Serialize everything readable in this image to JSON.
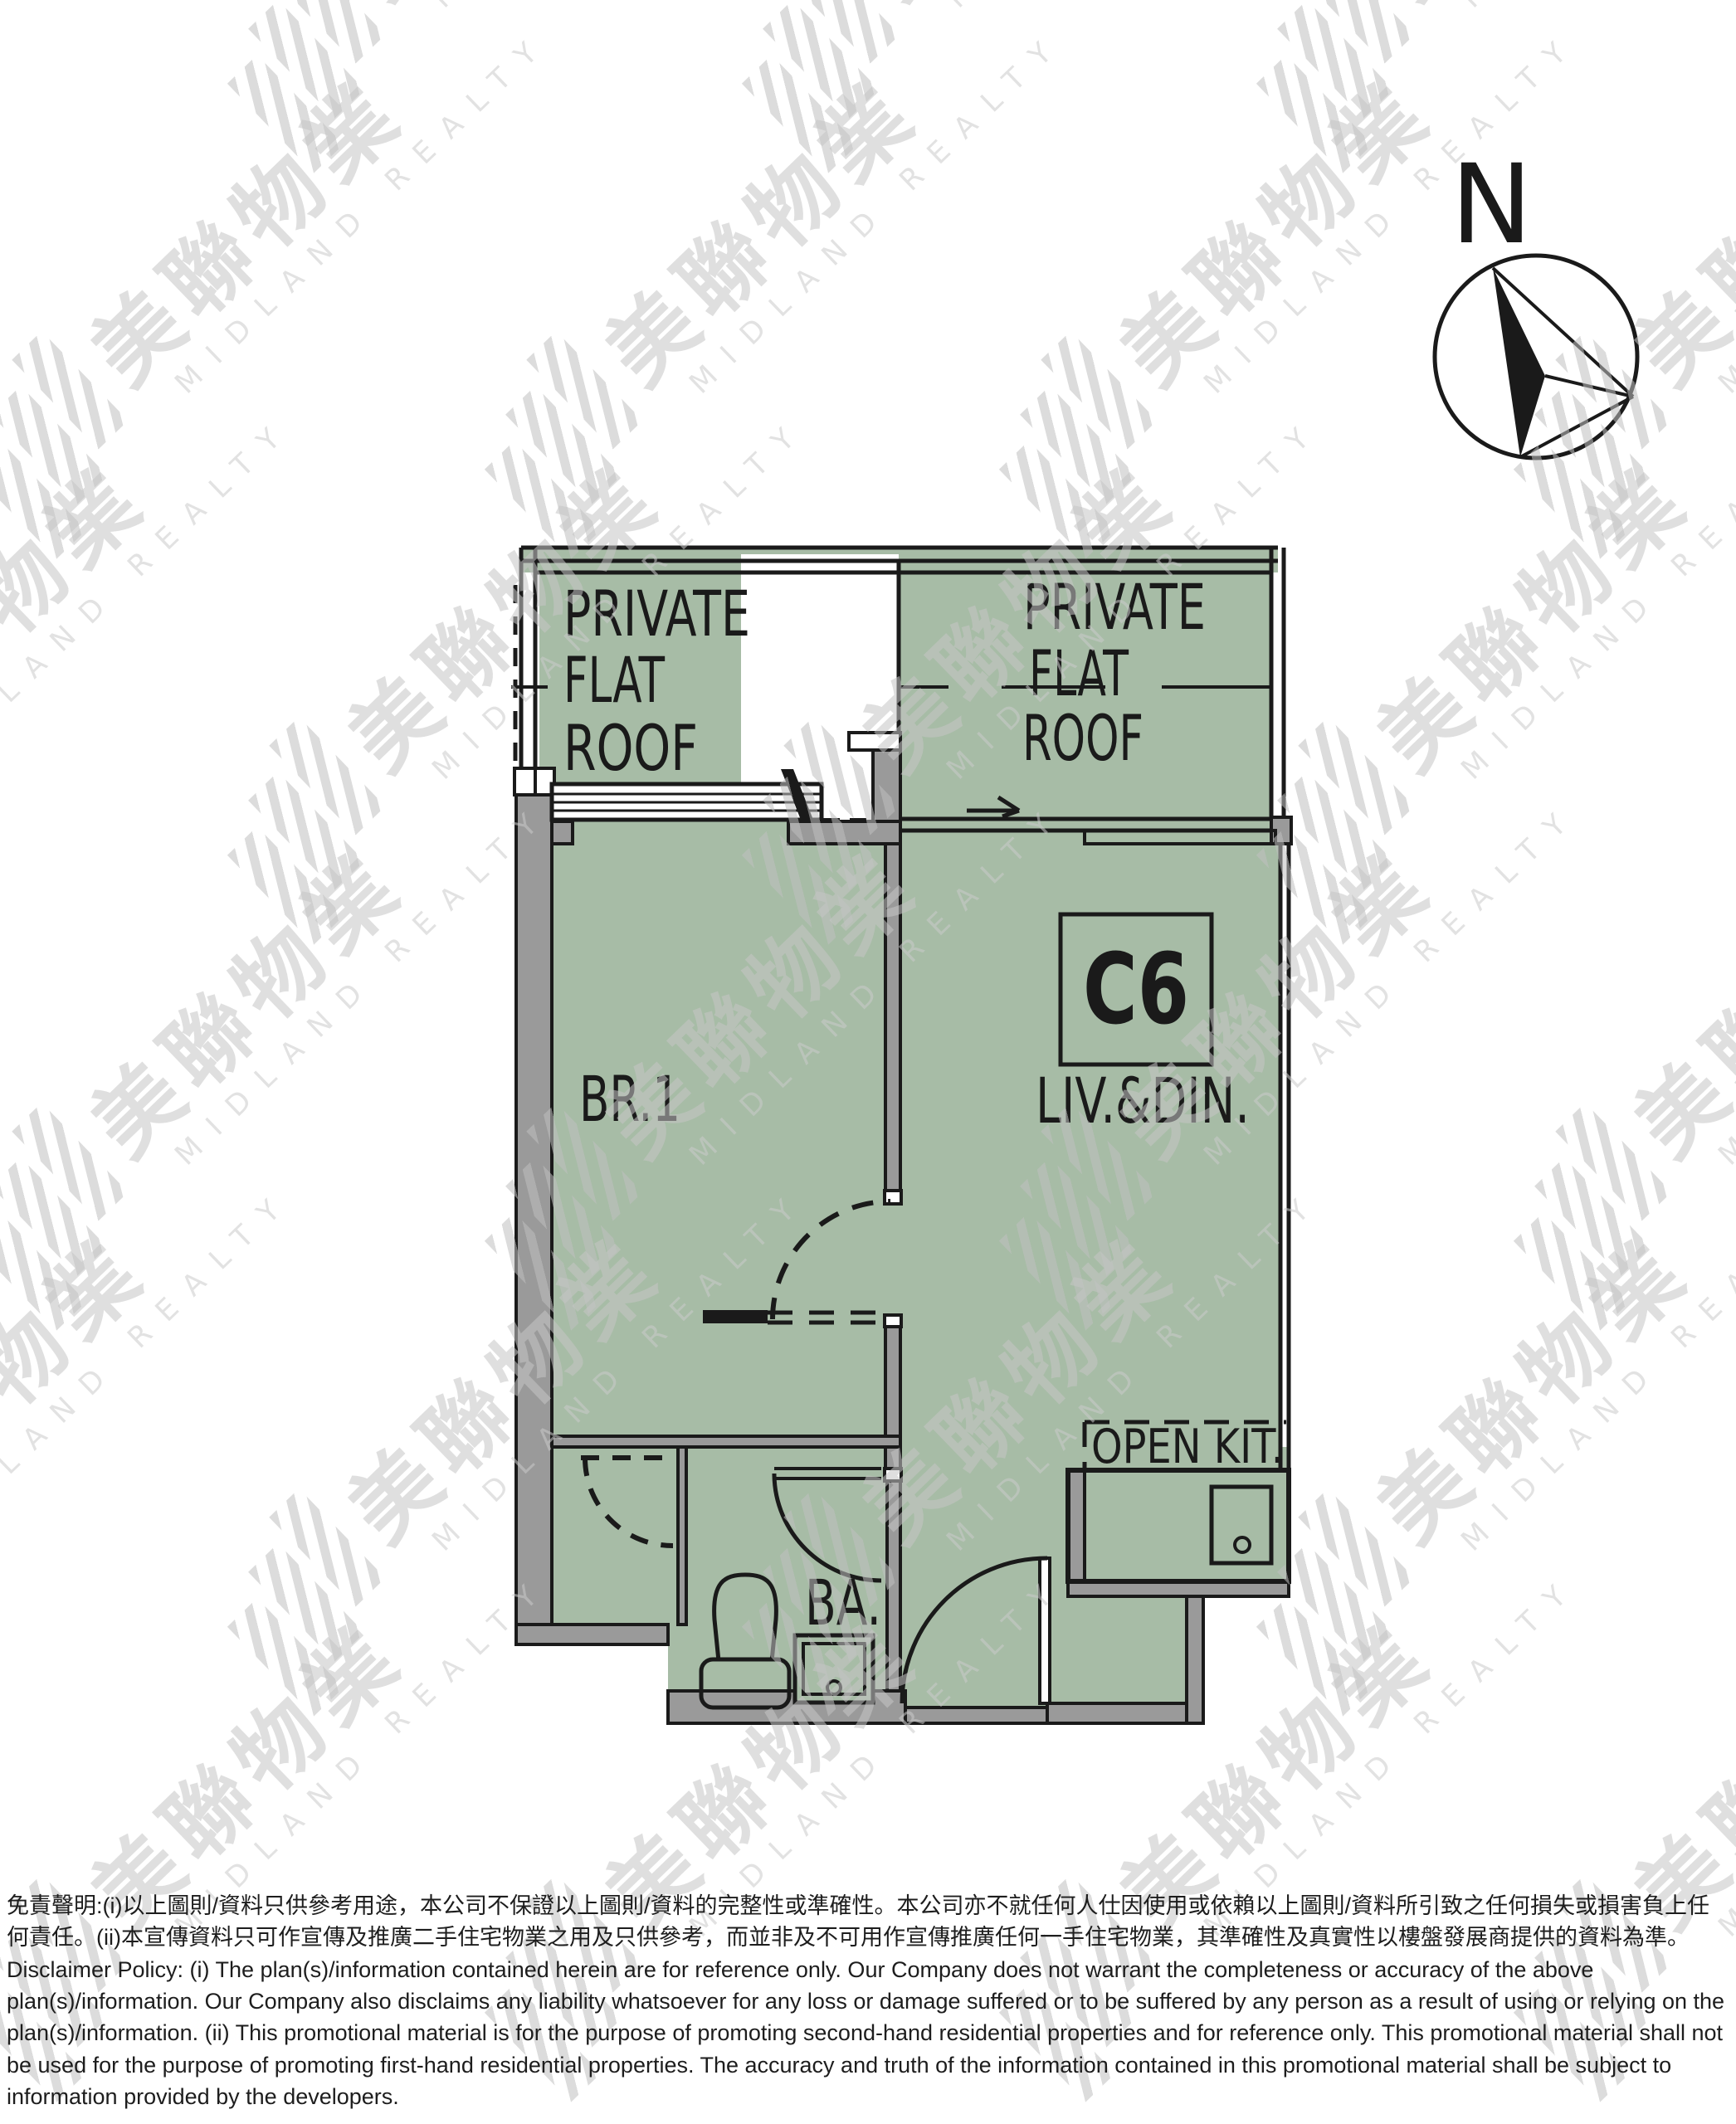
{
  "floor_plan": {
    "unit_label": "C6",
    "labels": {
      "flat_roof_left": {
        "line1": "PRIVATE",
        "line2": "FLAT",
        "line3": "ROOF"
      },
      "flat_roof_right": {
        "line1": "PRIVATE",
        "line2": "FLAT",
        "line3": "ROOF"
      },
      "bedroom": "BR.1",
      "living_dining": "LIV.&DIN.",
      "open_kitchen": "OPEN KIT.",
      "bathroom": "BA."
    },
    "compass_north_label": "N",
    "colors": {
      "floor_fill": "#a7bca6",
      "wall_fill": "#9a9a9a",
      "line": "#1a1a1a"
    }
  },
  "watermark": {
    "chinese": "美聯物業",
    "english": "MIDLAND REALTY"
  },
  "disclaimer": {
    "chinese": "免責聲明:(i)以上圖則/資料只供參考用途，本公司不保證以上圖則/資料的完整性或準確性。本公司亦不就任何人仕因使用或依賴以上圖則/資料所引致之任何損失或損害負上任何責任。(ii)本宣傳資料只可作宣傳及推廣二手住宅物業之用及只供參考，而並非及不可用作宣傳推廣任何一手住宅物業，其準確性及真實性以樓盤發展商提供的資料為準。",
    "english": "Disclaimer Policy: (i) The plan(s)/information contained herein are for reference only. Our Company does not warrant the completeness or accuracy of the above plan(s)/information. Our Company also disclaims any liability whatsoever for any loss or damage suffered or to be suffered by any person as a result of using or relying on the plan(s)/information. (ii) This promotional material is for the purpose of promoting second-hand residential properties and for reference only. This promotional material shall not be used for the purpose of promoting first-hand residential properties. The accuracy and truth of the information contained in this promotional material shall be subject to information provided by the developers."
  }
}
